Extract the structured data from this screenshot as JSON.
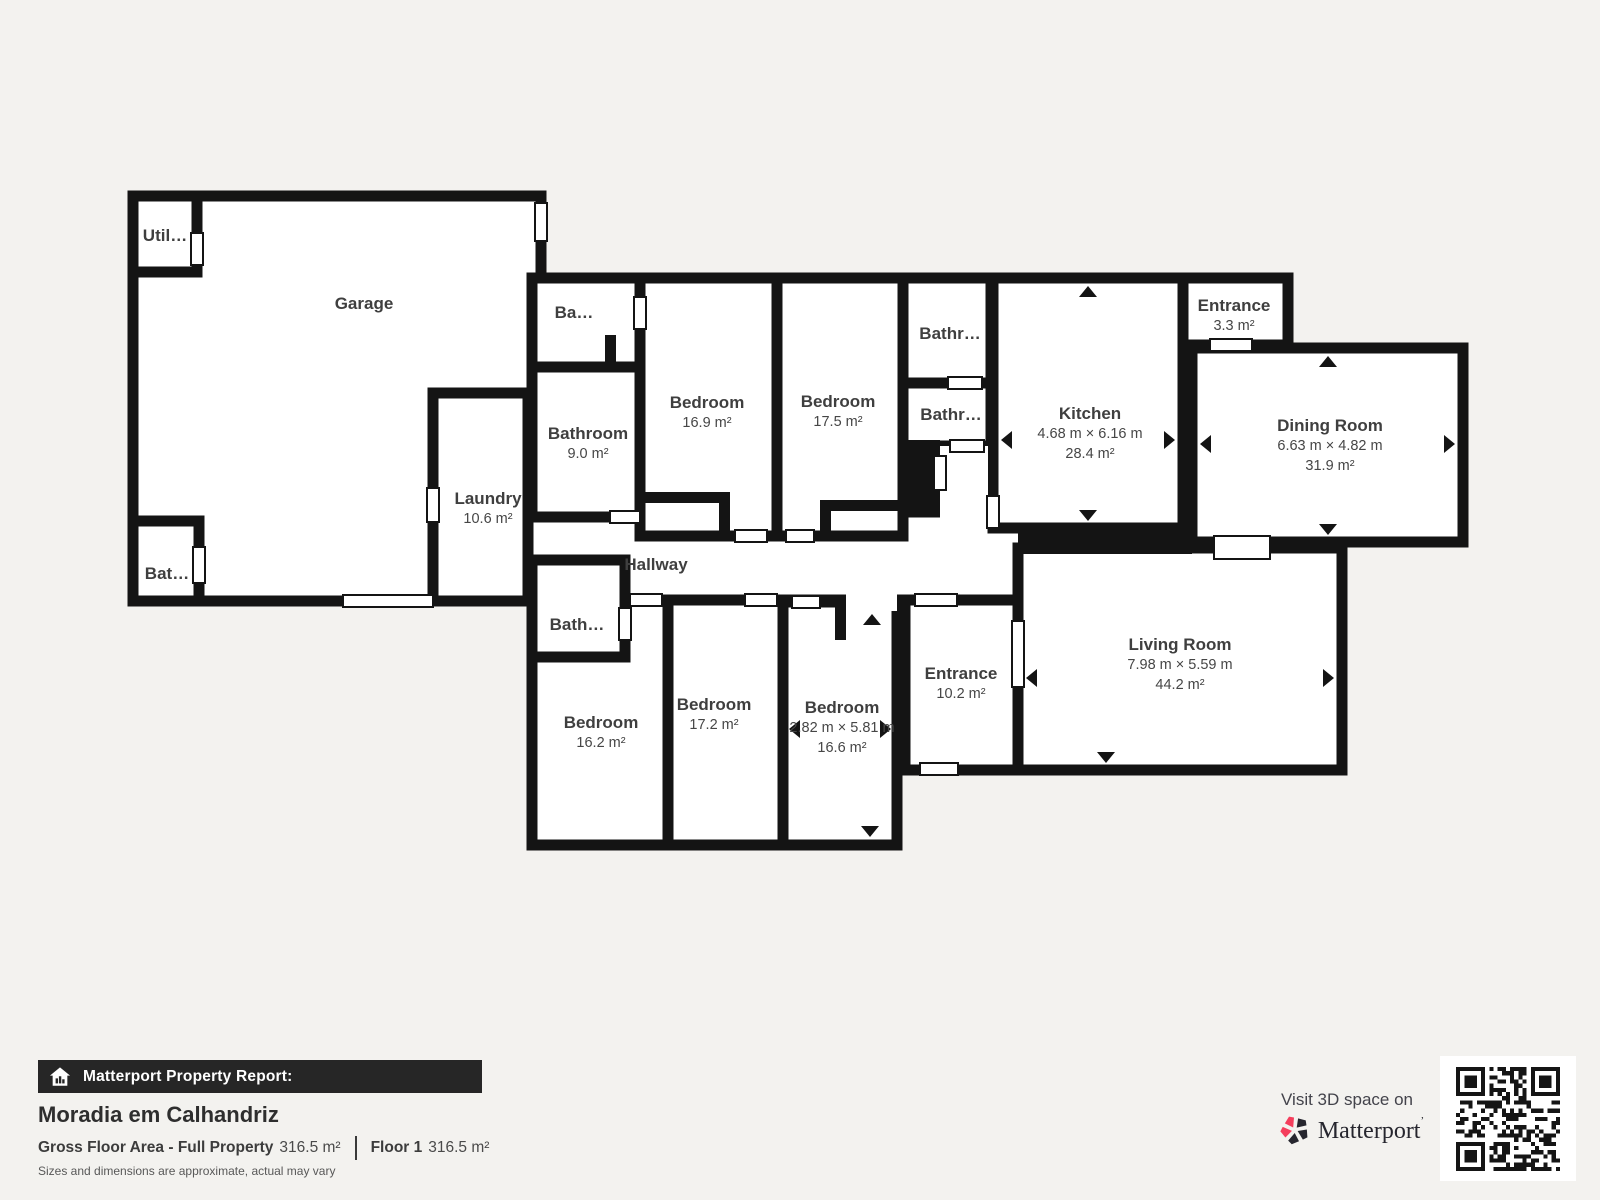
{
  "colors": {
    "background": "#f3f2ef",
    "wall": "#141414",
    "room_fill": "#ffffff",
    "bar_background": "#262626",
    "accent_red": "#f43e5c",
    "label_text": "#3f3f3f"
  },
  "plan": {
    "rooms": {
      "garage": {
        "name": "Garage"
      },
      "util": {
        "name": "Util…"
      },
      "bat_garage": {
        "name": "Bat…"
      },
      "laundry": {
        "name": "Laundry",
        "area": "10.6 m²"
      },
      "ba_top": {
        "name": "Ba…"
      },
      "bathroom9": {
        "name": "Bathroom",
        "area": "9.0 m²"
      },
      "bedroom169": {
        "name": "Bedroom",
        "area": "16.9 m²"
      },
      "bedroom175": {
        "name": "Bedroom",
        "area": "17.5 m²"
      },
      "bathr_upper": {
        "name": "Bathr…"
      },
      "bathr_lower": {
        "name": "Bathr…"
      },
      "kitchen": {
        "name": "Kitchen",
        "dims": "4.68 m × 6.16 m",
        "area": "28.4 m²"
      },
      "entrance_top": {
        "name": "Entrance",
        "area": "3.3 m²"
      },
      "dining": {
        "name": "Dining Room",
        "dims": "6.63 m × 4.82 m",
        "area": "31.9 m²"
      },
      "hallway": {
        "name": "Hallway"
      },
      "bath_small": {
        "name": "Bath…"
      },
      "bedroom162": {
        "name": "Bedroom",
        "area": "16.2 m²"
      },
      "bedroom172": {
        "name": "Bedroom",
        "area": "17.2 m²"
      },
      "bedroom166": {
        "name": "Bedroom",
        "dims": "2.82 m × 5.81 m",
        "area": "16.6 m²"
      },
      "entrance_lower": {
        "name": "Entrance",
        "area": "10.2 m²"
      },
      "living": {
        "name": "Living Room",
        "dims": "7.98 m × 5.59 m",
        "area": "44.2 m²"
      }
    }
  },
  "footer": {
    "report_label": "Matterport Property Report:",
    "property_name": "Moradia em Calhandriz",
    "gross_label": "Gross Floor Area - Full Property",
    "gross_value": "316.5 m²",
    "floor_label": "Floor 1",
    "floor_value": "316.5 m²",
    "disclaimer": "Sizes and dimensions are approximate, actual may vary"
  },
  "cta": {
    "visit_text": "Visit 3D space on",
    "brand": "Matterport",
    "brand_mark": "’"
  }
}
